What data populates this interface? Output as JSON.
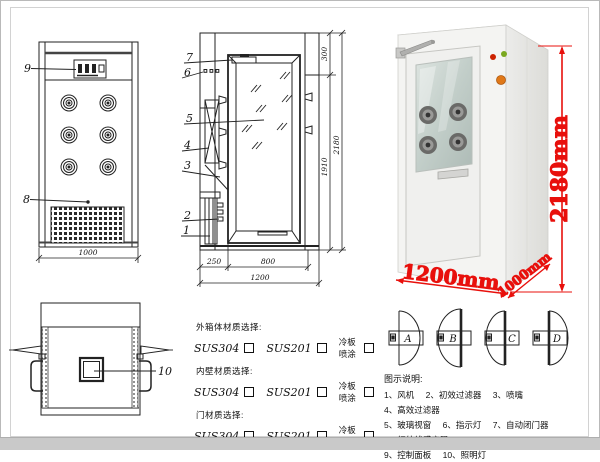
{
  "front_view": {
    "callout_9": "9",
    "callout_8": "8",
    "dim_width": "1000"
  },
  "side_view": {
    "callout_7": "7",
    "callout_6": "6",
    "callout_5": "5",
    "callout_4": "4",
    "callout_3": "3",
    "callout_2": "2",
    "callout_1": "1",
    "dim_top": "300",
    "dim_door_height": "1910",
    "dim_total_height": "2180",
    "dim_left": "250",
    "dim_door_width": "800",
    "dim_total_width": "1200"
  },
  "top_view": {
    "callout_10": "10"
  },
  "photo": {
    "dim_height": "2180mm",
    "dim_width": "1200mm",
    "dim_depth": "1000mm"
  },
  "materials": {
    "sections": [
      {
        "title": "外箱体材质选择:",
        "options": [
          "SUS304",
          "SUS201",
          "冷板喷涂"
        ]
      },
      {
        "title": "内壁材质选择:",
        "options": [
          "SUS304",
          "SUS201",
          "冷板喷涂"
        ]
      },
      {
        "title": "门材质选择:",
        "options": [
          "SUS304",
          "SUS201",
          "冷板喷涂"
        ]
      }
    ]
  },
  "doors": {
    "options": [
      "A",
      "B",
      "C",
      "D"
    ]
  },
  "legend": {
    "title": "图示说明:",
    "rows": [
      [
        "1、风机",
        "2、初效过滤器",
        "3、喷嘴",
        "4、高效过滤器"
      ],
      [
        "5、玻璃视窗",
        "6、指示灯",
        "7、自动闭门器",
        "8、红外线感应器"
      ],
      [
        "9、控制面板",
        "10、照明灯"
      ]
    ]
  },
  "colors": {
    "dimension_red": "#e8100c",
    "indicator_red": "#cc2200",
    "indicator_green": "#7aa820",
    "indicator_orange": "#e07818",
    "cabinet_front": "#f4f4f2",
    "cabinet_side": "#e7e7e4",
    "glass": "#c9d4d0"
  }
}
